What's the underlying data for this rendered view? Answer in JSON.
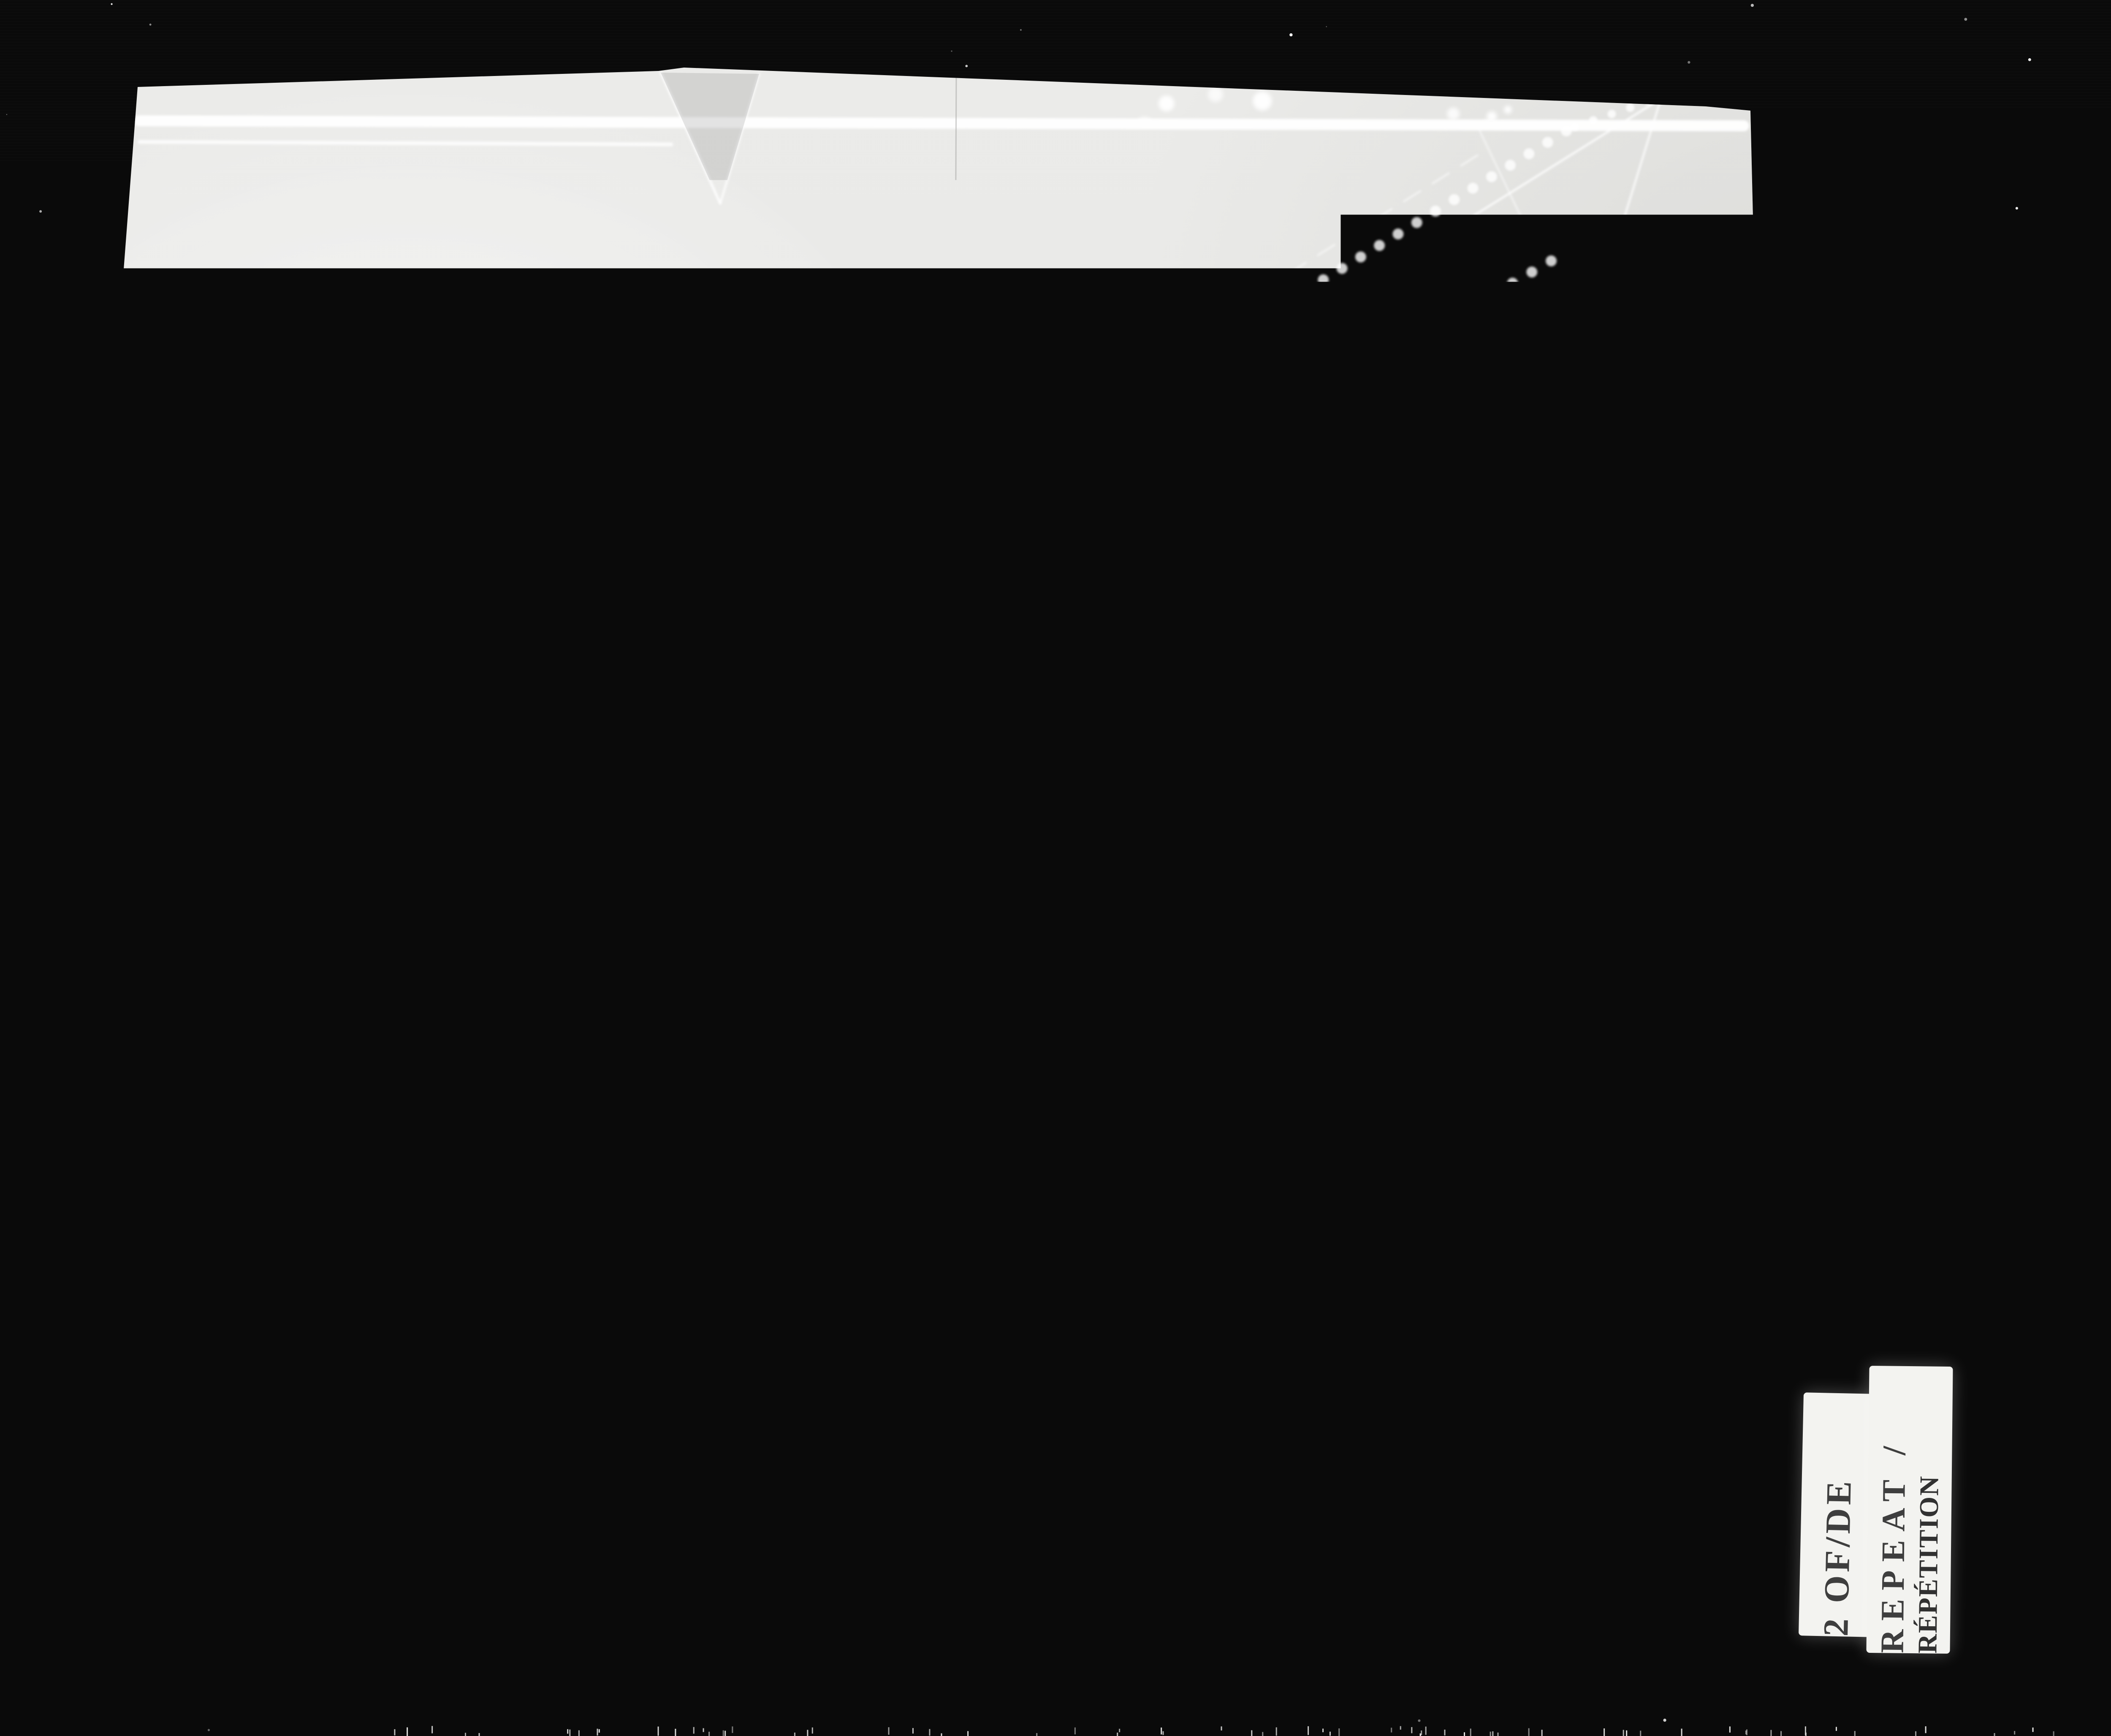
{
  "map": {
    "title": "BANFF ALBERTA.",
    "credit": {
      "initials": "E.M.W.",
      "line1": "Resident Engineer's Office",
      "line2": "Banff National Park",
      "line3": "16th Jan. 1936"
    },
    "note": {
      "heading": "Note",
      "rows": [
        {
          "label": "Approx. Elevation",
          "value": "4590",
          "suffix": "G.S.C."
        },
        {
          "label": "Latitude",
          "value": "51°12′30″",
          "suffix": ""
        },
        {
          "label": "Longitude",
          "value": "115°32′15″",
          "suffix": ""
        }
      ]
    },
    "labels": {
      "scrub": "Scrub",
      "monitor": "MONITOR",
      "cleared": "Cleared of Trees 600 feet wide",
      "clearing900": "Clearing 900 feet wide",
      "power_line": "Power trans. line  Low tension",
      "power_poles": "Power Poles",
      "road": "Road",
      "to_calgary": "To Calgary",
      "arrow": "⟶",
      "d3200": "3200′",
      "d2400": "2400′",
      "d600": "600′"
    }
  },
  "film": {
    "frame_label": "2 OF/DE",
    "repeat_label_en": "REPEAT /",
    "repeat_label_fr": "RÉPÉTITION",
    "edge_marking": "4 B 54",
    "surround_color": "#0a0a0a",
    "sheet_color": "#ebebe9",
    "line_color": "#ffffff"
  },
  "decor": {
    "lines": [
      [
        206,
        2563,
        4060,
        155,
        5,
        0.8,
        ""
      ],
      [
        206,
        2430,
        3520,
        355,
        4,
        0.6,
        "46 34"
      ],
      [
        206,
        3240,
        4172,
        761,
        6,
        0.95,
        ""
      ],
      [
        206,
        3406,
        4172,
        928,
        5,
        0.9,
        ""
      ],
      [
        206,
        3534,
        4172,
        1058,
        4,
        0.8,
        ""
      ],
      [
        885,
        4112,
        4172,
        2057,
        4,
        0.85,
        ""
      ],
      [
        1240,
        4112,
        4210,
        2280,
        3,
        0.6,
        ""
      ],
      [
        1546,
        4112,
        4140,
        799,
        9,
        1.0,
        ""
      ],
      [
        1568,
        4118,
        4150,
        815,
        6,
        0.9,
        ""
      ],
      [
        2001,
        4112,
        4172,
        1550,
        5,
        0.8,
        ""
      ],
      [
        2031,
        4112,
        4200,
        1562,
        3,
        0.5,
        ""
      ],
      [
        206,
        2850,
        1480,
        4112,
        5,
        0.8,
        ""
      ],
      [
        206,
        3240,
        980,
        4112,
        4,
        0.7,
        ""
      ],
      [
        206,
        3930,
        600,
        4112,
        3,
        0.6,
        ""
      ],
      [
        2870,
        1560,
        3960,
        540,
        5,
        0.8,
        "44 36"
      ],
      [
        3080,
        1690,
        4140,
        710,
        4,
        0.7,
        "40 34"
      ],
      [
        3932,
        240,
        3657,
        1133,
        5,
        0.75,
        ""
      ],
      [
        3500,
        300,
        3980,
        1300,
        4,
        0.55,
        ""
      ],
      [
        330,
        286,
        4130,
        298,
        26,
        0.95,
        ""
      ],
      [
        330,
        336,
        1590,
        342,
        9,
        0.8,
        ""
      ],
      [
        268,
        1500,
        284,
        3620,
        7,
        0.8,
        ""
      ],
      [
        215,
        2600,
        218,
        4050,
        5,
        0.7,
        ""
      ],
      [
        1565,
        172,
        1706,
        482,
        6,
        0.85,
        ""
      ],
      [
        1706,
        482,
        1798,
        175,
        5,
        0.8,
        ""
      ],
      [
        3480,
        2100,
        3600,
        2060,
        5,
        0.7,
        ""
      ]
    ],
    "chains": [
      [
        3090,
        690,
        3710,
        310,
        13,
        50
      ],
      [
        2988,
        1013,
        3674,
        618,
        13,
        50
      ],
      [
        2456,
        1494,
        3005,
        1185,
        12,
        48
      ],
      [
        1202,
        2198,
        2404,
        1528,
        12,
        48
      ],
      [
        3435,
        1375,
        4050,
        860,
        8,
        38
      ],
      [
        3730,
        300,
        4080,
        180,
        10,
        44
      ]
    ],
    "tree_bands": [
      [
        250,
        2100,
        3600,
        180,
        380,
        150,
        9,
        24
      ],
      [
        220,
        2780,
        1500,
        2030,
        300,
        80,
        9,
        22
      ],
      [
        250,
        3600,
        2250,
        4040,
        320,
        110,
        8,
        22
      ],
      [
        3260,
        900,
        3950,
        460,
        250,
        55,
        8,
        20
      ],
      [
        2480,
        3280,
        3320,
        2420,
        120,
        28,
        7,
        16
      ]
    ],
    "noise": {
      "count": 160
    },
    "ticks": {
      "count": 80
    }
  }
}
